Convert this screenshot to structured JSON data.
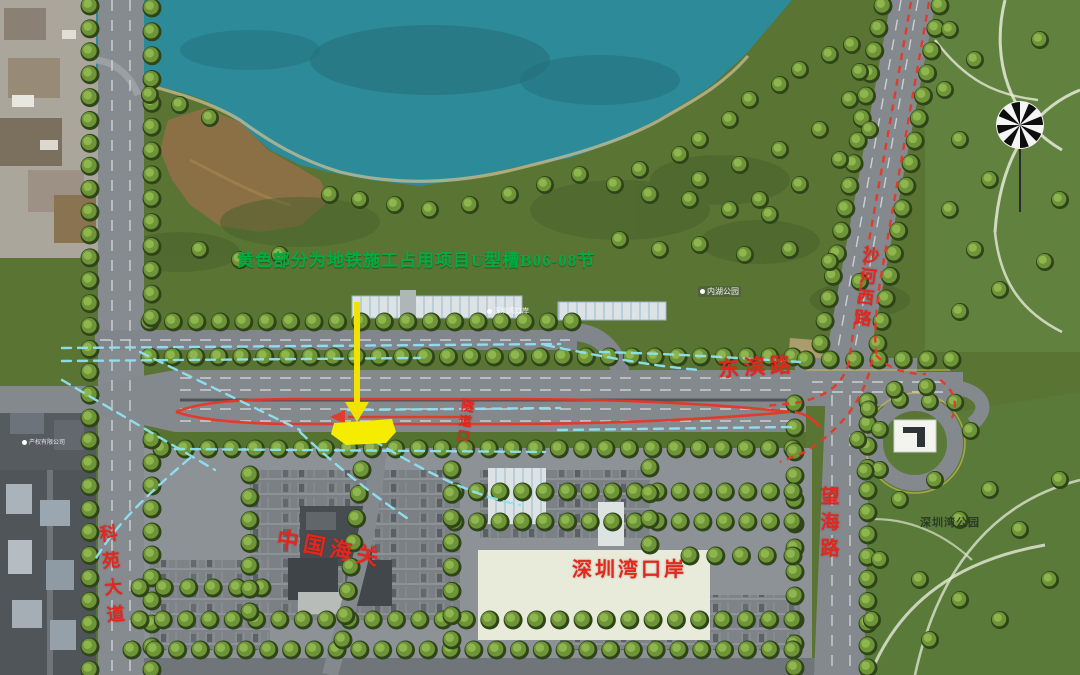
{
  "annotation": {
    "note_text": "黄色部分为地铁施工占用项目U型槽B06-08节"
  },
  "road_labels": {
    "keyuan": "科苑大道",
    "dongbin": "东滨路",
    "shahexi": "沙河西路",
    "wanghai": "望海路",
    "tunnel_portal": "隧道口"
  },
  "place_labels": {
    "customs": "中国海关",
    "port": "深圳湾口岸",
    "bay_park": "深圳湾公园"
  },
  "poi_labels": {
    "poi_port": "深圳湾口岸",
    "poi_park": "内湖公园",
    "poi_company": "产权有限公司"
  },
  "colors": {
    "note_green": "#00ad44",
    "label_red": "#e0281e",
    "route_red": "#e53826",
    "flow_cyan": "#8fe2f2",
    "highlight_yellow": "#f6ec00",
    "water_teal": "#2d8b99"
  }
}
